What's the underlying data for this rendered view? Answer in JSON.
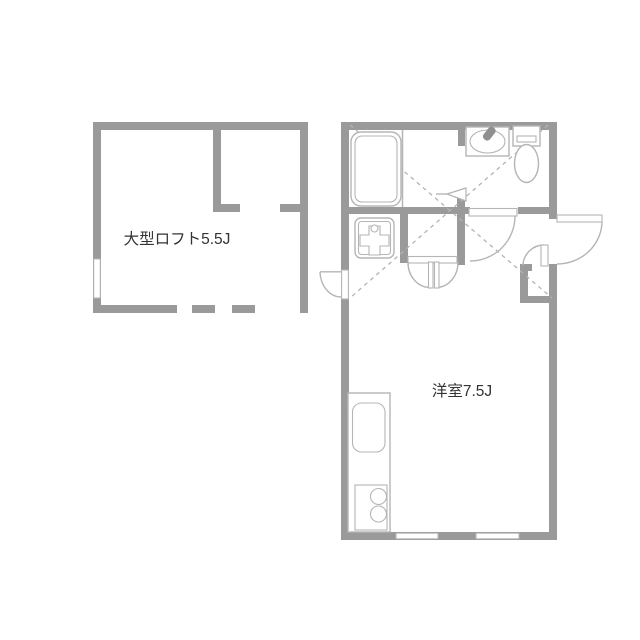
{
  "page": {
    "title": "floor-plan"
  },
  "labels": {
    "loft": "大型ロフト5.5J",
    "room": "洋室7.5J"
  },
  "fixtures": [
    "bathtub-icon",
    "washbasin-icon",
    "toilet-icon",
    "washing-machine-pan-icon",
    "kitchen-sink-icon",
    "stove-burners-icon",
    "entrance-door-arc-icon",
    "closet-double-door-icon",
    "window-marker",
    "loft-extent-dashed-cross",
    "ladder-arrow-icon"
  ],
  "colors": {
    "wall": "#9a9a9a",
    "fixture": "#b5b5b5",
    "dashed": "#b3b3b3",
    "text": "#333333",
    "background": "#ffffff",
    "faucet": "#8f8f8f"
  }
}
